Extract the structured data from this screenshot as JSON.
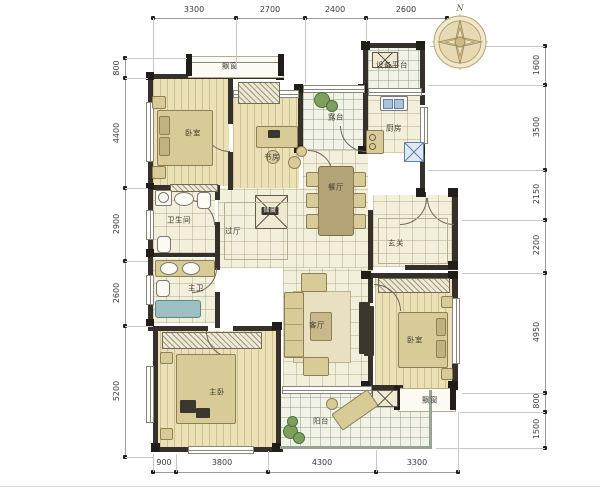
{
  "plan": {
    "type": "apartment-floor-plan"
  },
  "compass": {
    "north": "N"
  },
  "dims": {
    "top": [
      "3300",
      "2700",
      "2400",
      "2600"
    ],
    "bottom": [
      "900",
      "3800",
      "4300",
      "3300"
    ],
    "left": [
      "800",
      "4400",
      "2900",
      "2600",
      "5200"
    ],
    "right": [
      "1600",
      "3500",
      "2150",
      "2200",
      "4950",
      "800",
      "1500"
    ]
  },
  "rooms": {
    "bay_top": "飘窗",
    "bedroom_top": "卧室",
    "study": "书房",
    "terrace": "露台",
    "equipment_platform": "设备平台",
    "kitchen": "厨房",
    "dining": "餐厅",
    "foyer": "玄关",
    "bathroom": "卫生间",
    "hallway": "过厅",
    "storage": "储藏",
    "master_bath": "主卫",
    "master_bedroom": "主卧",
    "living": "客厅",
    "balcony": "阳台",
    "bedroom_right": "卧室",
    "bay_bottom": "飘窗"
  },
  "palette": {
    "wall": "#35312a",
    "wood_floor": "#ece1b6",
    "tile_floor": "#f2efda",
    "terrace_tile": "#f1f3e7",
    "furniture": "#d9cb97",
    "water_fixture": "#9ec0c2",
    "blue_fixture": "#aac4e0",
    "plant": "#7da05f",
    "dimension_line": "#9a9a9a"
  }
}
